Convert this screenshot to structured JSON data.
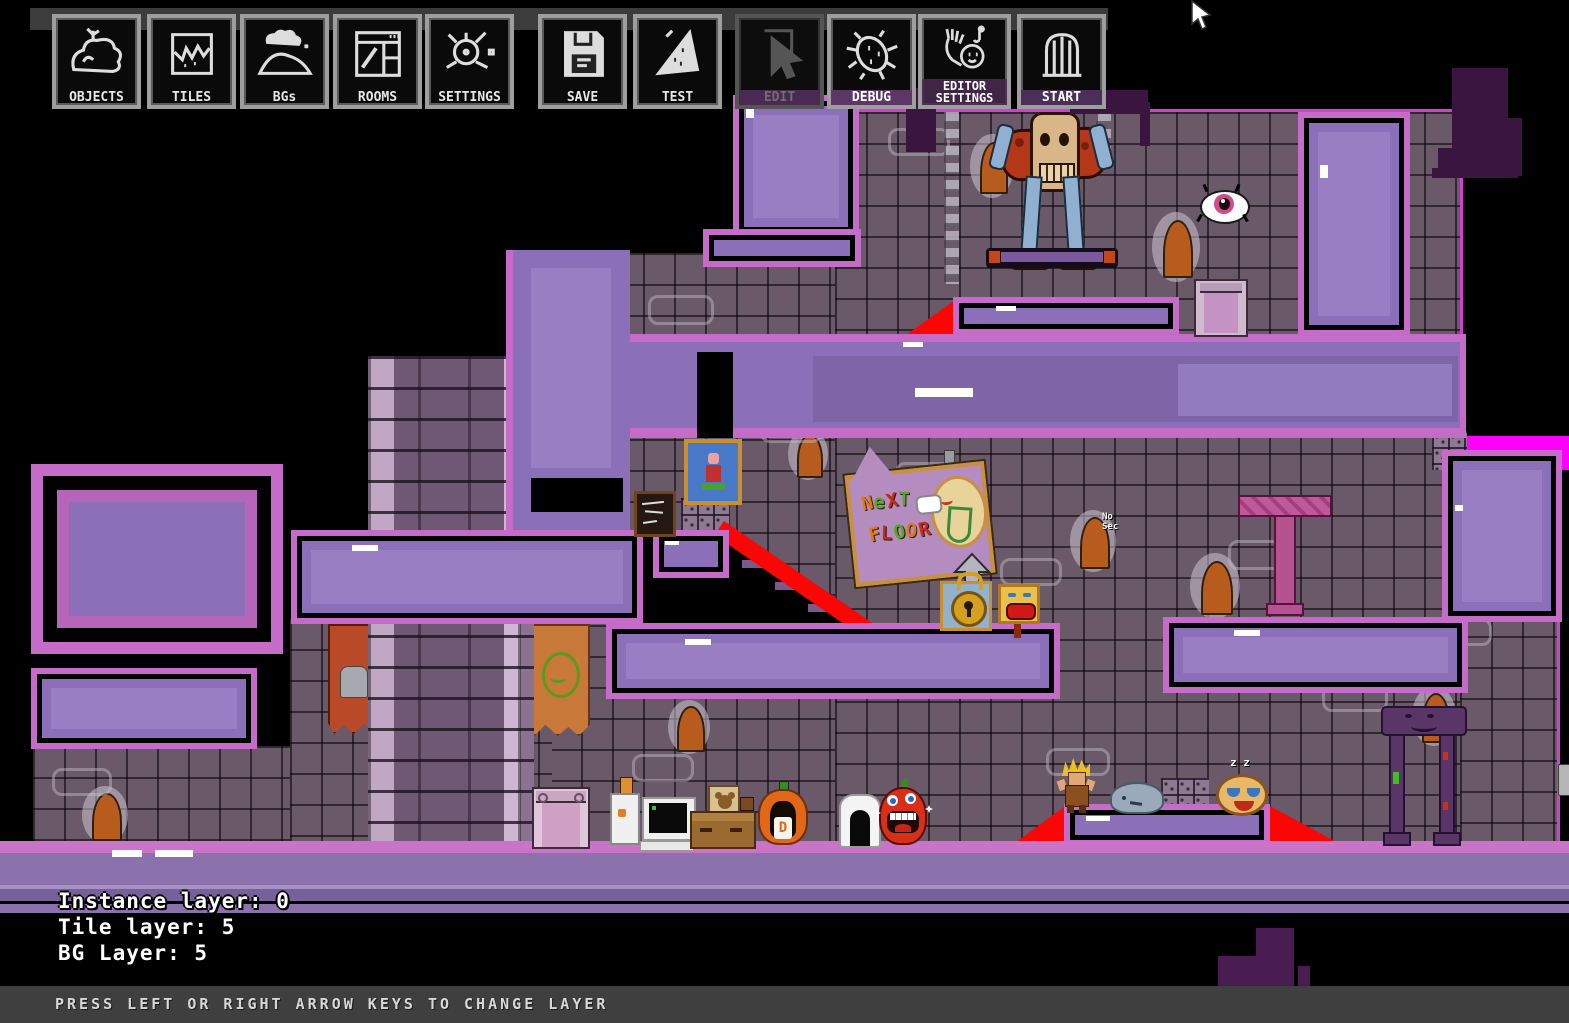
{
  "toolbar": {
    "buttons": [
      {
        "label": "OBJECTS",
        "icon": "rock-icon",
        "enabled": true
      },
      {
        "label": "TILES",
        "icon": "broken-tile-icon",
        "enabled": true
      },
      {
        "label": "BGs",
        "icon": "cloud-hill-icon",
        "enabled": true
      },
      {
        "label": "ROOMS",
        "icon": "window-icon",
        "enabled": true
      },
      {
        "label": "SETTINGS",
        "icon": "knob-icon",
        "enabled": true
      },
      {
        "label": "SAVE",
        "icon": "floppy-disk-icon",
        "enabled": true
      },
      {
        "label": "TEST",
        "icon": "pizza-slice-icon",
        "enabled": true
      },
      {
        "label": "EDIT",
        "icon": "cursor-icon",
        "enabled": false
      },
      {
        "label": "DEBUG",
        "icon": "bug-icon",
        "enabled": true
      },
      {
        "label": "EDITOR\nSETTINGS",
        "icon": "hand-face-icon",
        "enabled": true
      },
      {
        "label": "START",
        "icon": "door-icon",
        "enabled": true
      }
    ]
  },
  "hud": {
    "lines": [
      "Instance layer: 0",
      "Tile layer: 5",
      "BG Layer: 5"
    ]
  },
  "status_bar": {
    "message": "PRESS LEFT OR RIGHT ARROW KEYS TO CHANGE LAYER"
  },
  "level": {
    "next_floor_sign": {
      "line1": "NeXT",
      "line2": "FLOOR",
      "letter_colors": [
        "#e07818",
        "#58a828",
        "#d02818",
        "#58a828",
        "#e07818",
        "#d02818",
        "#58a828",
        "#e07818",
        "#d02818"
      ]
    },
    "note": {
      "text": "No\nSec"
    },
    "sleeping_pizza": {
      "text": "z z"
    },
    "pumpkin": {
      "letter": "D"
    },
    "colors": {
      "platform_fill": "#8b6fb8",
      "platform_border": "#c46cc8",
      "slope_red": "#fb0505",
      "tile_background": "#695969",
      "magenta_marker": "#ff00ff",
      "floor_pink": "#c973c9",
      "outside_black": "#000000"
    }
  }
}
